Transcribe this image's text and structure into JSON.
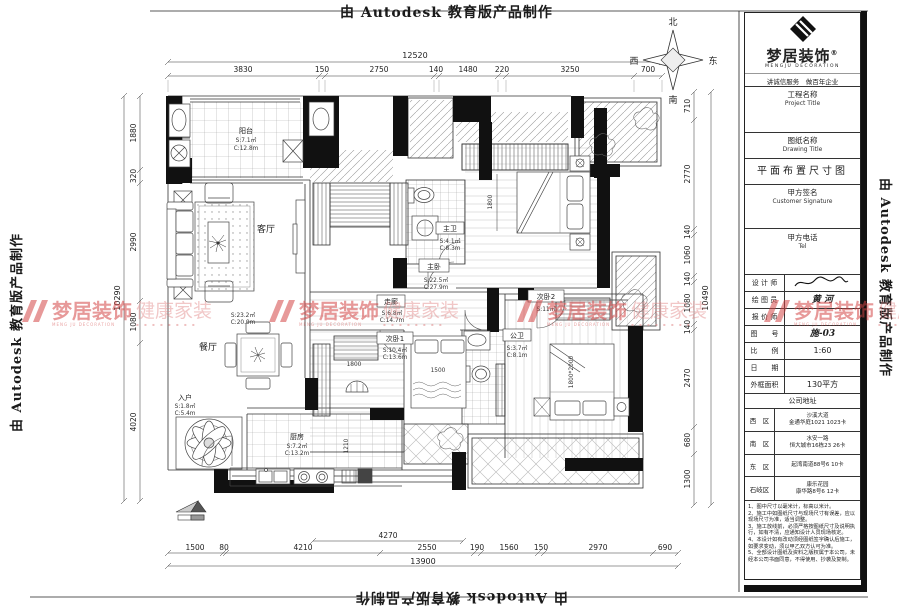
{
  "autodesk_watermark": "由 Autodesk 教育版产品制作",
  "brand": {
    "name": "梦居装饰",
    "reg": "®",
    "name_en": "MENGJU DECORATION",
    "slogan": "讲诚信服务　做百年企业",
    "wm_tag": "健康家装",
    "wm_sub": "MENG JU DECORATION",
    "wm_dots": "▪ ▪ ▪ ▪ ▪ ▪ ▪ ▪"
  },
  "compass": {
    "north": "北",
    "south": "南",
    "east": "东",
    "west": "西"
  },
  "titleblock": {
    "project_label": "工程名称",
    "project_label_en": "Project Title",
    "drawing_label": "图纸名称",
    "drawing_label_en": "Drawing Title",
    "drawing_title": "平面布置尺寸图",
    "customer_label": "甲方签名",
    "customer_label_en": "Customer Signature",
    "tel_label": "甲方电话",
    "tel_label_en": "Tel",
    "designer_label": "设 计 师",
    "designer_value": "",
    "draftsman_label": "绘 图 员",
    "draftsman_value": "黄 河",
    "quoter_label": "报 价 师",
    "quoter_value": "",
    "sheet_label": "图　　号",
    "sheet_value": "施-03",
    "scale_label": "比　　例",
    "scale_value": "1:60",
    "date_label": "日　　期",
    "date_value": "",
    "area_label": "外框面积",
    "area_value": "130平方",
    "address_label": "公司地址",
    "addresses": [
      {
        "zone": "西　区",
        "line1": "沙溪大道",
        "line2": "金通华庭1021  1023卡"
      },
      {
        "zone": "南　区",
        "line1": "水安一路",
        "line2": "恒大城市16栋23  26卡"
      },
      {
        "zone": "东　区",
        "line1": "起湾南道88号6  10卡",
        "line2": ""
      },
      {
        "zone": "石岐区",
        "line1": "康乐花园",
        "line2": "康华路8号6  12卡"
      }
    ],
    "notes": [
      "1、图中尺寸以毫米计，标高以米计。",
      "2、施工中如图纸尺寸与现场尺寸有误差，应以现场尺寸为准，适当调整。",
      "3、施工放线前，必须严格按图纸尺寸及说明执行，如有不清，应通知设计人员现场核定。",
      "4、本设计如有改动须经图纸签字确认后施工，如要求变动，须以甲乙双方认可为准。",
      "5、全部设计图纸及资料之版权属于本公司，未经本公司书面同意，不得使用、抄袭及复制。"
    ]
  },
  "rooms": {
    "balcony": {
      "name": "阳台",
      "s": "S:7.1㎡",
      "c": "C:12.8m"
    },
    "living": {
      "name": "客厅",
      "s": "S:23.2㎡",
      "c": "C:20.9m"
    },
    "dining": {
      "name": "餐厅"
    },
    "entry": {
      "name": "入户",
      "s": "S:1.8㎡",
      "c": "C:5.4m"
    },
    "kitchen": {
      "name": "厨房",
      "s": "S:7.2㎡",
      "c": "C:13.2m"
    },
    "corridor": {
      "name": "走廊",
      "s": "S:6.8㎡",
      "c": "C:14.7m"
    },
    "master_bedroom": {
      "name": "主卧",
      "s": "S:22.5㎡",
      "c": "C:27.9m"
    },
    "master_bath": {
      "name": "主卫",
      "s": "S:4.1㎡",
      "c": "C:8.3m"
    },
    "bedroom2": {
      "name": "次卧1",
      "s": "S:10.4㎡",
      "c": "C:13.6m"
    },
    "bedroom3": {
      "name": "次卧2",
      "s": "S:11㎡"
    },
    "public_bath": {
      "name": "公卫",
      "s": "S:3.7㎡",
      "c": "C:8.1m"
    }
  },
  "dims": {
    "top": {
      "total": "12520",
      "segments": [
        "3830",
        "150",
        "2750",
        "140",
        "1480",
        "220",
        "3250",
        "700"
      ]
    },
    "left": {
      "total": "10290",
      "segments": [
        "1880",
        "320",
        "2990",
        "1080",
        "4020"
      ]
    },
    "right": {
      "total": "10490",
      "segments": [
        "710",
        "2770",
        "140",
        "1060",
        "140",
        "1080",
        "140",
        "2470",
        "680",
        "1300"
      ]
    },
    "bottom": {
      "total": "13900",
      "sub": "4270",
      "segments": [
        "1500",
        "80",
        "4210",
        "2550",
        "190",
        "1560",
        "150",
        "2970",
        "690"
      ]
    },
    "inner": {
      "master_bed": "1800",
      "bed2": "1500",
      "bed2_wardrobe": "1800",
      "bed3_bed": "1800*2000",
      "kitchen": "1210"
    }
  }
}
